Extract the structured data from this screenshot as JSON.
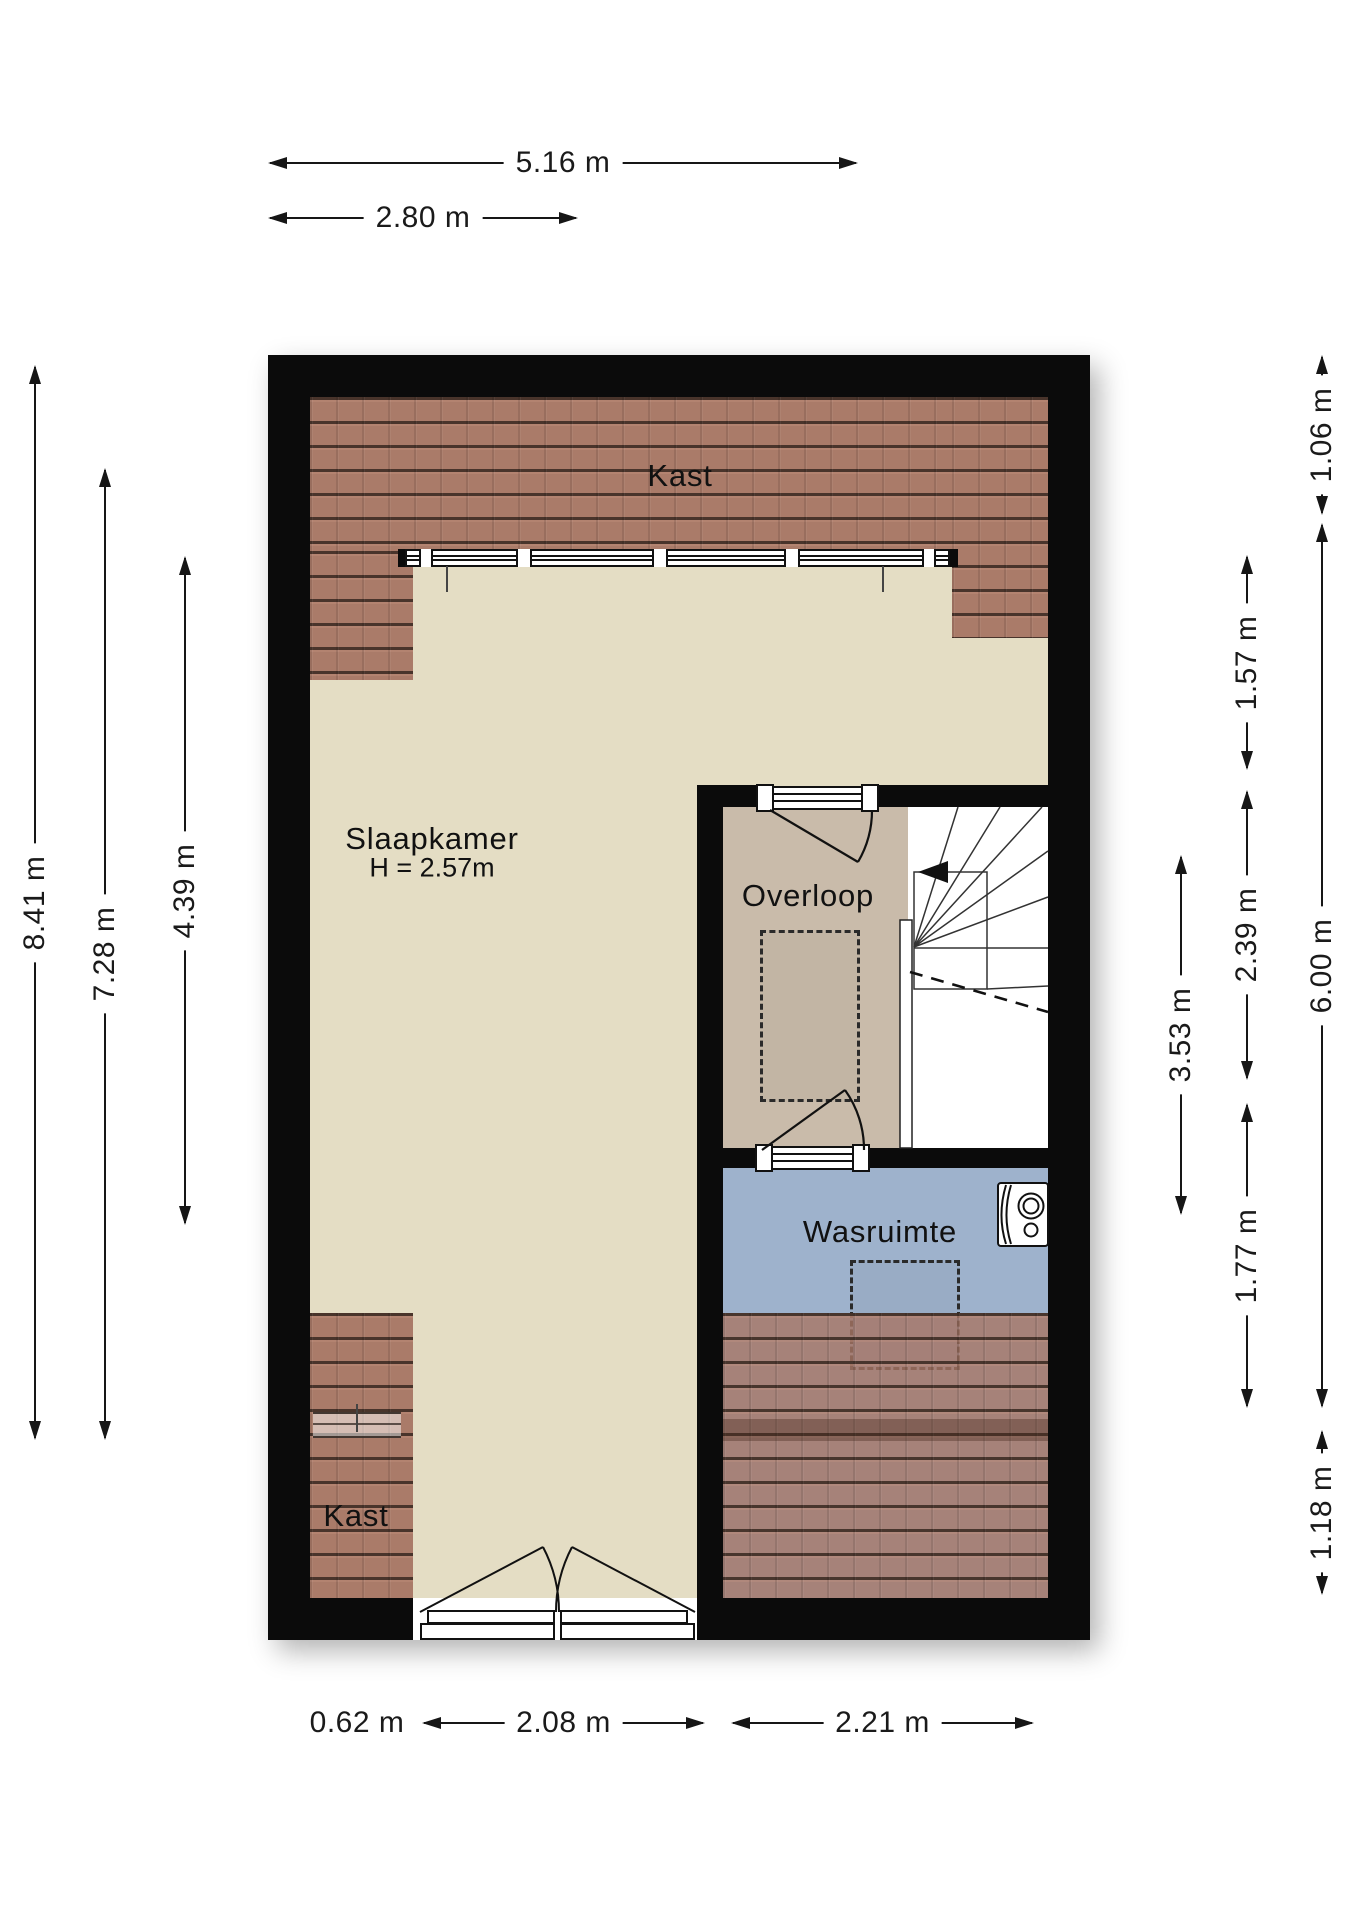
{
  "rooms": {
    "kast_top": {
      "label": "Kast"
    },
    "slaapkamer": {
      "label": "Slaapkamer",
      "height_label": "H = 2.57m"
    },
    "overloop": {
      "label": "Overloop"
    },
    "wasruimte": {
      "label": "Wasruimte"
    },
    "kast_bottom": {
      "label": "Kast"
    }
  },
  "dimensions": {
    "top": [
      {
        "label": "5.16 m"
      },
      {
        "label": "2.80 m"
      }
    ],
    "left": [
      {
        "label": "8.41 m"
      },
      {
        "label": "7.28 m"
      },
      {
        "label": "4.39 m"
      }
    ],
    "right": [
      {
        "label": "1.06 m"
      },
      {
        "label": "1.57 m"
      },
      {
        "label": "2.39 m"
      },
      {
        "label": "3.53 m"
      },
      {
        "label": "1.77 m"
      },
      {
        "label": "6.00 m"
      },
      {
        "label": "1.18 m"
      }
    ],
    "bottom": [
      {
        "label": "0.62 m"
      },
      {
        "label": "2.08 m"
      },
      {
        "label": "2.21 m"
      }
    ]
  },
  "colors": {
    "wall": "#0b0b0b",
    "slaapkamer_floor": "#e4ddc4",
    "overloop_floor": "#c9bbaa",
    "wasruimte_floor": "#9eb2cc",
    "roof_tiles": "#a77565",
    "dimension_lines": "#161616"
  },
  "icons": {
    "washing_machine": "washing-machine-icon",
    "stairs_direction": "stairs-direction-arrow-icon"
  }
}
